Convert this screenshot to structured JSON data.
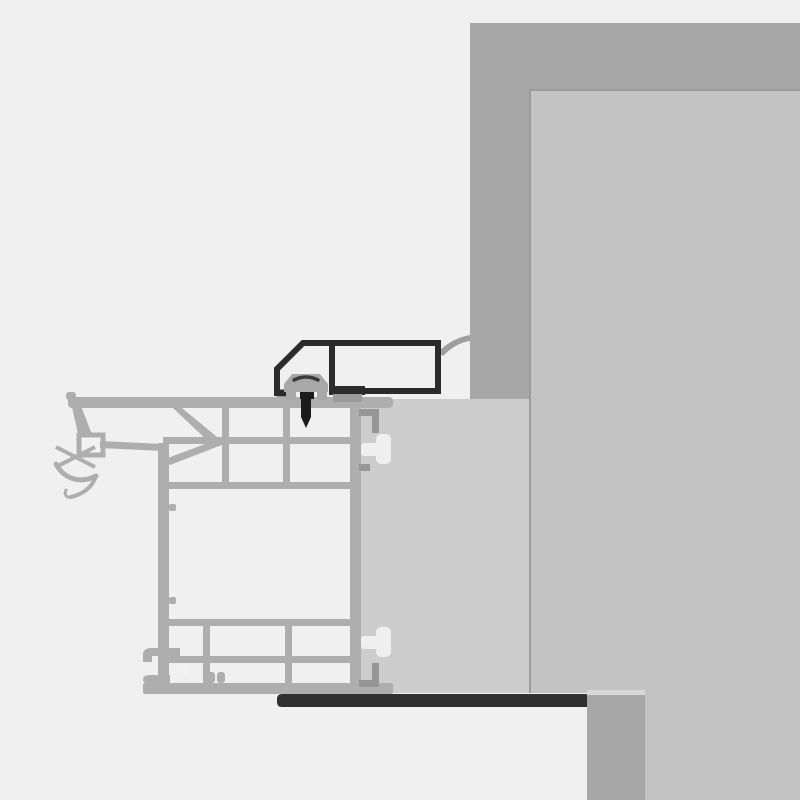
{
  "canvas": {
    "width": 800,
    "height": 800
  },
  "colors": {
    "background": "#f0f0f0",
    "wall_band": "#a7a7a7",
    "interior_panel": "#c3c3c3",
    "panel_edge": "#9b9b9b",
    "filler_block": "#cdcdcd",
    "frame_profile": "#aeaeae",
    "chamber_fill": "#f2f2f2",
    "lug_fill": "#efefef",
    "hook_gray": "#969696",
    "bracket_black": "#2b2b2b",
    "pad_gray": "#9a9a9a",
    "clip_gray": "#a8a8a8",
    "clip_slot": "#3b3b3b",
    "screw_black": "#1b1b1b",
    "membrane_gray": "#9e9e9e",
    "seal_strip": "#303030",
    "seam_light": "#d8d8d8"
  }
}
